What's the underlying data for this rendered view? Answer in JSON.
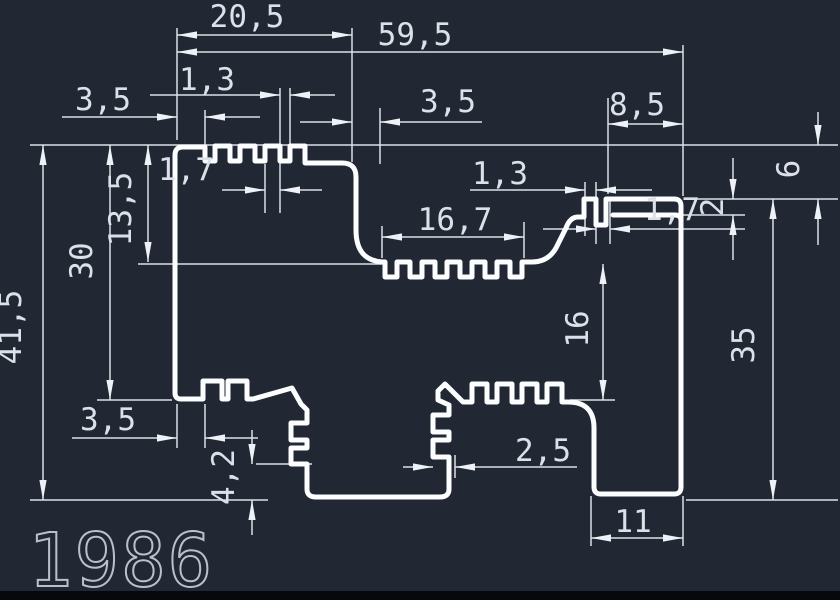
{
  "canvas": {
    "background_color": "#222833",
    "profile_line_color": "#fcfdfe",
    "dimension_color": "#dce0e8",
    "part_number_color": "#b9c0cb"
  },
  "profile": {
    "part_number": "1986"
  },
  "dims": {
    "top_section_width": "20,5",
    "overall_width": "59,5",
    "top_fin_gap": "1,3",
    "top_fin_width": "1,7",
    "top_left_offset": "3,5",
    "top_step_width": "3,5",
    "top_right_width": "8,5",
    "right_step_height": "6",
    "mid_fin_gap": "1,3",
    "mid_lip_width": "1,7",
    "lip_thickness": "2",
    "right_height": "35",
    "cavity_height": "16",
    "mid_comb_width": "16,7",
    "upper_cavity_depth": "13,5",
    "left_flange_height": "30",
    "overall_height": "41,5",
    "bottom_left_offset": "3,5",
    "bottom_fin_depth": "2,5",
    "bottom_notch_height": "4,2",
    "foot_width": "11"
  }
}
